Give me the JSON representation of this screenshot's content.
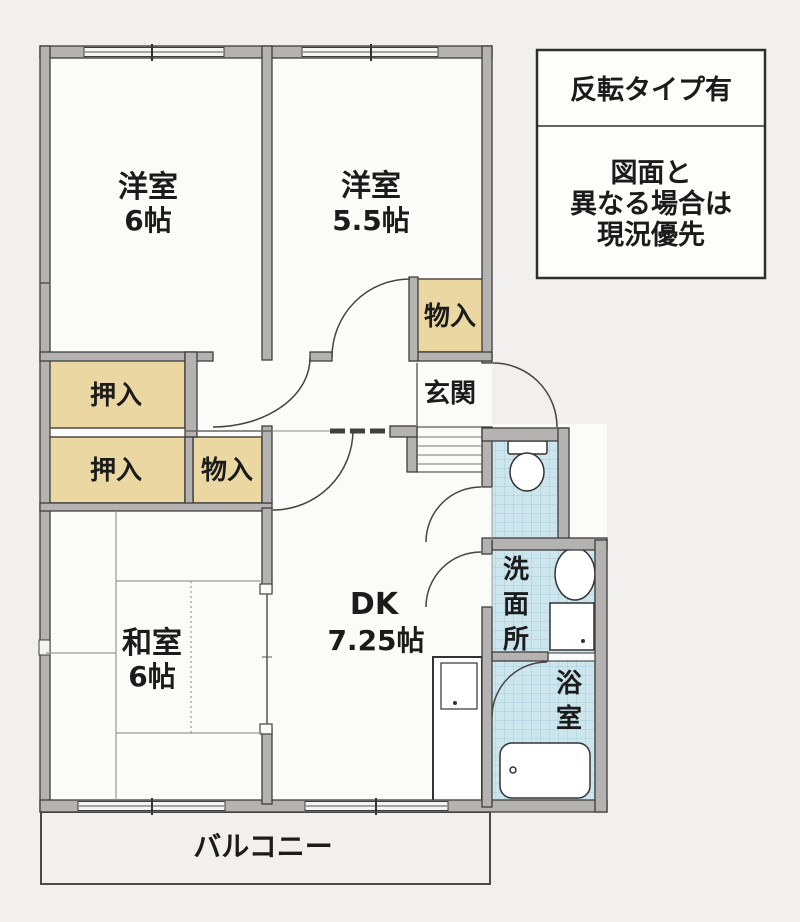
{
  "plan_title": "apartment-floor-plan",
  "colors": {
    "wall_fill": "#b4b3b1",
    "closet_fill": "#ead7a2",
    "wet_area_fill": "#cde6ed",
    "background": "#f1f0ee",
    "line": "#3e3e3e"
  },
  "rooms": {
    "yoshitsu6": {
      "name": "洋室",
      "size": "6帖"
    },
    "yoshitsu55": {
      "name": "洋室",
      "size": "5.5帖"
    },
    "washitsu": {
      "name": "和室",
      "size": "6帖"
    },
    "dk": {
      "name": "DK",
      "size": "7.25帖"
    },
    "genkan": {
      "label": "玄関"
    },
    "balcony": {
      "label": "バルコニー"
    },
    "senmenjo": {
      "chars": [
        "洗",
        "面",
        "所"
      ]
    },
    "yokushitsu": {
      "chars": [
        "浴",
        "室"
      ]
    }
  },
  "closets": {
    "oshiire_upper": "押入",
    "oshiire_lower": "押入",
    "monoire_hall": "物入",
    "monoire_bedroom": "物入"
  },
  "note_box": {
    "line1": "反転タイプ有",
    "line2": "図面と",
    "line3": "異なる場合は",
    "line4": "現況優先"
  }
}
